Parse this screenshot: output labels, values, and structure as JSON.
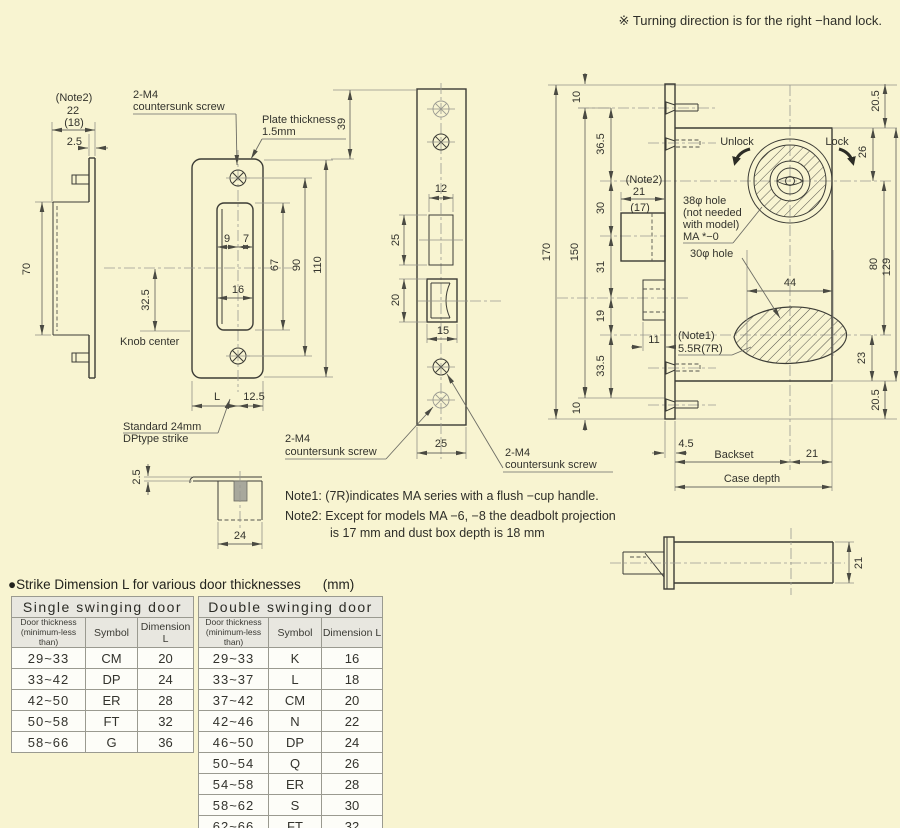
{
  "page": {
    "top_note": "※ Turning direction is for the right −hand lock.",
    "notes": {
      "note1": "Note1: (7R)indicates MA series with a flush −cup handle.",
      "note2_line1": "Note2: Except for models MA −6, −8 the deadbolt projection",
      "note2_line2": "is 17 mm and dust box depth is 18 mm"
    }
  },
  "views": {
    "strike_side": {
      "note_ref": "(Note2)",
      "depth": "22",
      "depth_alt": "(18)",
      "lip": "2.5",
      "height": "70",
      "knob_offset": "32.5",
      "knob_center": "Knob center"
    },
    "strike_front": {
      "screw1": "2-M4",
      "screw2": "countersunk screw",
      "plate1": "Plate thickness",
      "plate2": "1.5mm",
      "d9": "9",
      "d7": "7",
      "d16": "16",
      "d67": "67",
      "d90": "90",
      "d110": "110",
      "dL": "L",
      "d12_5": "12.5",
      "standard1": "Standard 24mm",
      "standard2": "DPtype strike"
    },
    "faceplate": {
      "d39": "39",
      "d12": "12",
      "d25a": "25",
      "d20": "20",
      "d15": "15",
      "d25b": "25",
      "screwL1": "2-M4",
      "screwL2": "countersunk screw",
      "screwR1": "2-M4",
      "screwR2": "countersunk screw"
    },
    "lock_body": {
      "d170": "170",
      "d150": "150",
      "d10t": "10",
      "d10b": "10",
      "d36_5": "36.5",
      "d30": "30",
      "d31": "31",
      "d19": "19",
      "d33_5": "33.5",
      "note_ref": "(Note2)",
      "d21db": "21",
      "d17": "(17)",
      "d11": "11",
      "unlock": "Unlock",
      "lock": "Lock",
      "d20_5t": "20.5",
      "d26": "26",
      "d80": "80",
      "d129": "129",
      "d23": "23",
      "d20_5b": "20.5",
      "d44": "44",
      "hole38_1": "38φ hole",
      "hole38_2": "(not needed",
      "hole38_3": "with model)",
      "hole38_4": "MA *−0",
      "hole30": "30φ hole",
      "note1_ref": "(Note1)",
      "radius": "5.5R(7R)",
      "d4_5": "4.5",
      "backset": "Backset",
      "d21c": "21",
      "case_depth": "Case depth"
    },
    "case_side": {
      "d21": "21"
    },
    "dust_box": {
      "lip": "2.5",
      "width": "24"
    }
  },
  "strike_table": {
    "title": "●Strike Dimension L for various door thicknesses",
    "unit": "(mm)",
    "headers": {
      "thickness1": "Door thickness",
      "thickness2": "(minimum-less than)",
      "symbol": "Symbol",
      "dimension": "Dimension L"
    },
    "single": {
      "title": "Single swinging door",
      "rows": [
        {
          "range": "29~33",
          "symbol": "CM",
          "dim": "20"
        },
        {
          "range": "33~42",
          "symbol": "DP",
          "dim": "24"
        },
        {
          "range": "42~50",
          "symbol": "ER",
          "dim": "28"
        },
        {
          "range": "50~58",
          "symbol": "FT",
          "dim": "32"
        },
        {
          "range": "58~66",
          "symbol": "G",
          "dim": "36"
        }
      ]
    },
    "double": {
      "title": "Double swinging door",
      "rows": [
        {
          "range": "29~33",
          "symbol": "K",
          "dim": "16"
        },
        {
          "range": "33~37",
          "symbol": "L",
          "dim": "18"
        },
        {
          "range": "37~42",
          "symbol": "CM",
          "dim": "20"
        },
        {
          "range": "42~46",
          "symbol": "N",
          "dim": "22"
        },
        {
          "range": "46~50",
          "symbol": "DP",
          "dim": "24"
        },
        {
          "range": "50~54",
          "symbol": "Q",
          "dim": "26"
        },
        {
          "range": "54~58",
          "symbol": "ER",
          "dim": "28"
        },
        {
          "range": "58~62",
          "symbol": "S",
          "dim": "30"
        },
        {
          "range": "62~66",
          "symbol": "FT",
          "dim": "32"
        }
      ]
    }
  }
}
